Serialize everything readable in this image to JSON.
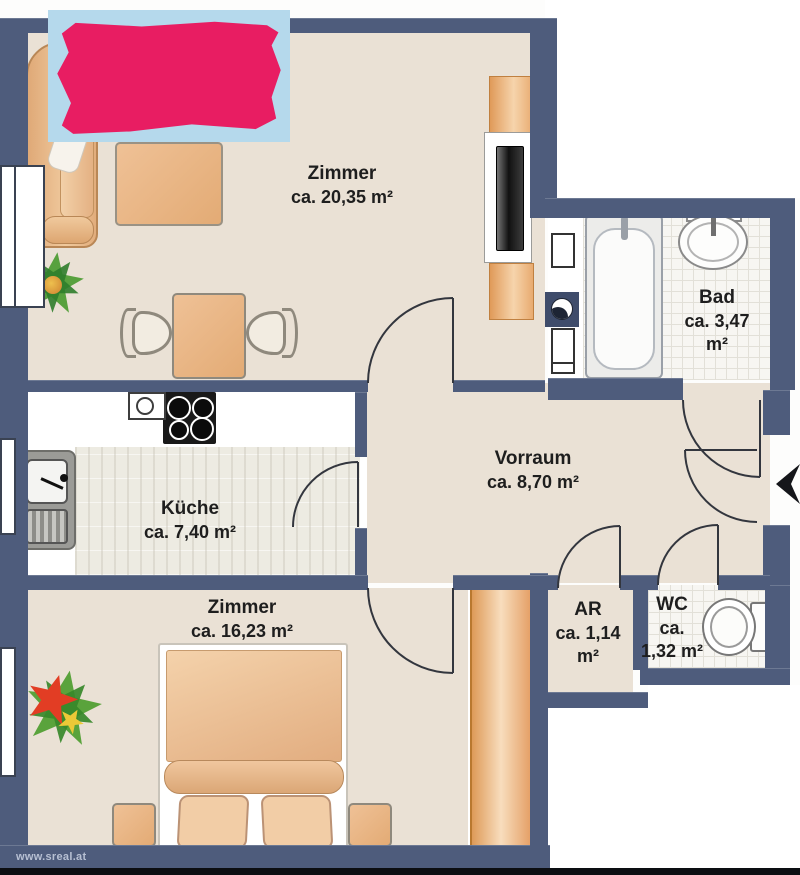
{
  "floorplan": {
    "watermark": "www.sreal.at",
    "rooms": {
      "living": {
        "name": "Zimmer",
        "area": "ca. 20,35  m²"
      },
      "bath": {
        "name": "Bad",
        "area_l1": "ca. 3,47",
        "area_l2": "m²"
      },
      "hall": {
        "name": "Vorraum",
        "area": "ca. 8,70 m²"
      },
      "kitchen": {
        "name": "Küche",
        "area": "ca. 7,40 m²"
      },
      "bedroom": {
        "name": "Zimmer",
        "area": "ca. 16,23 m²"
      },
      "storage": {
        "name": "AR",
        "area_l1": "ca. 1,14",
        "area_l2": "m²"
      },
      "wc": {
        "name": "WC",
        "area_l1": "ca.",
        "area_l2": "1,32 m²"
      }
    },
    "colors": {
      "wall": "#4e5c7c",
      "floor": "#eae1d5",
      "wood": "#e8b27d",
      "redaction": "#e81d62",
      "redaction_bg": "#b5d9ec",
      "tile_bg": "#f7f6f2"
    }
  }
}
